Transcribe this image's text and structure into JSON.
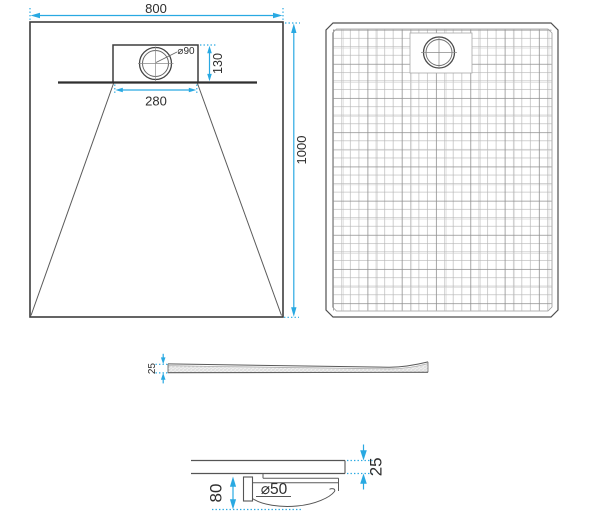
{
  "drawing": {
    "front_view": {
      "overall_width": "800",
      "overall_length": "1000",
      "drain_panel_width": "280",
      "drain_panel_height": "130",
      "drain_diameter": "⌀90"
    },
    "side_view": {
      "edge_thickness": "25"
    },
    "detail_view": {
      "tray_thickness": "25",
      "trap_depth": "80",
      "waste_pipe_diameter": "⌀50"
    },
    "colors": {
      "dimension_accent": "#29a9e2",
      "outline": "#3d3d3d"
    }
  }
}
